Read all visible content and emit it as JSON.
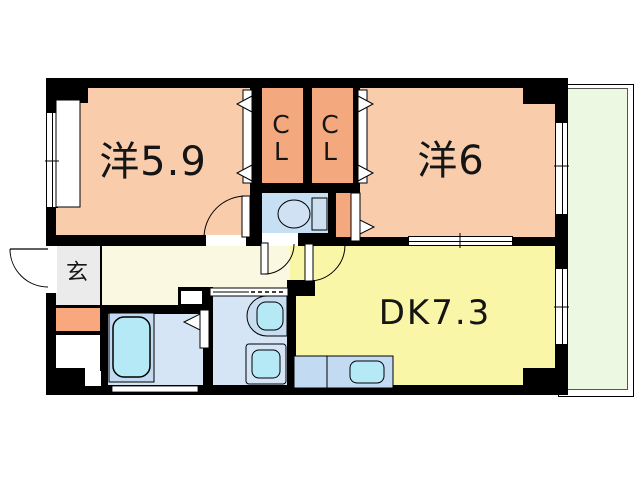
{
  "document": {
    "type": "apartment-floor-plan"
  },
  "rooms": {
    "bedroom1": {
      "label": "洋5.9"
    },
    "bedroom2": {
      "label": "洋6"
    },
    "dining_kitchen": {
      "label": "DK7.3"
    },
    "closet1": {
      "letter1": "C",
      "letter2": "L"
    },
    "closet2": {
      "letter1": "C",
      "letter2": "L"
    },
    "entrance": {
      "label": "玄"
    }
  },
  "colors": {
    "wall": "#000000",
    "bedroom": "#F9CDAB",
    "closet": "#F3A87E",
    "dining_kitchen": "#FAF6A8",
    "hallway": "#FBF8E2",
    "entrance_floor": "#EBEBEB",
    "shoe_cabinet": "#F9A87E",
    "wet_area_floor": "#CCE0F4",
    "fixture_blue": "#C2DAF2",
    "fixture_cyan": "#B5E9F6",
    "balcony": "#EDF8E3",
    "background": "#FFFFFF"
  }
}
